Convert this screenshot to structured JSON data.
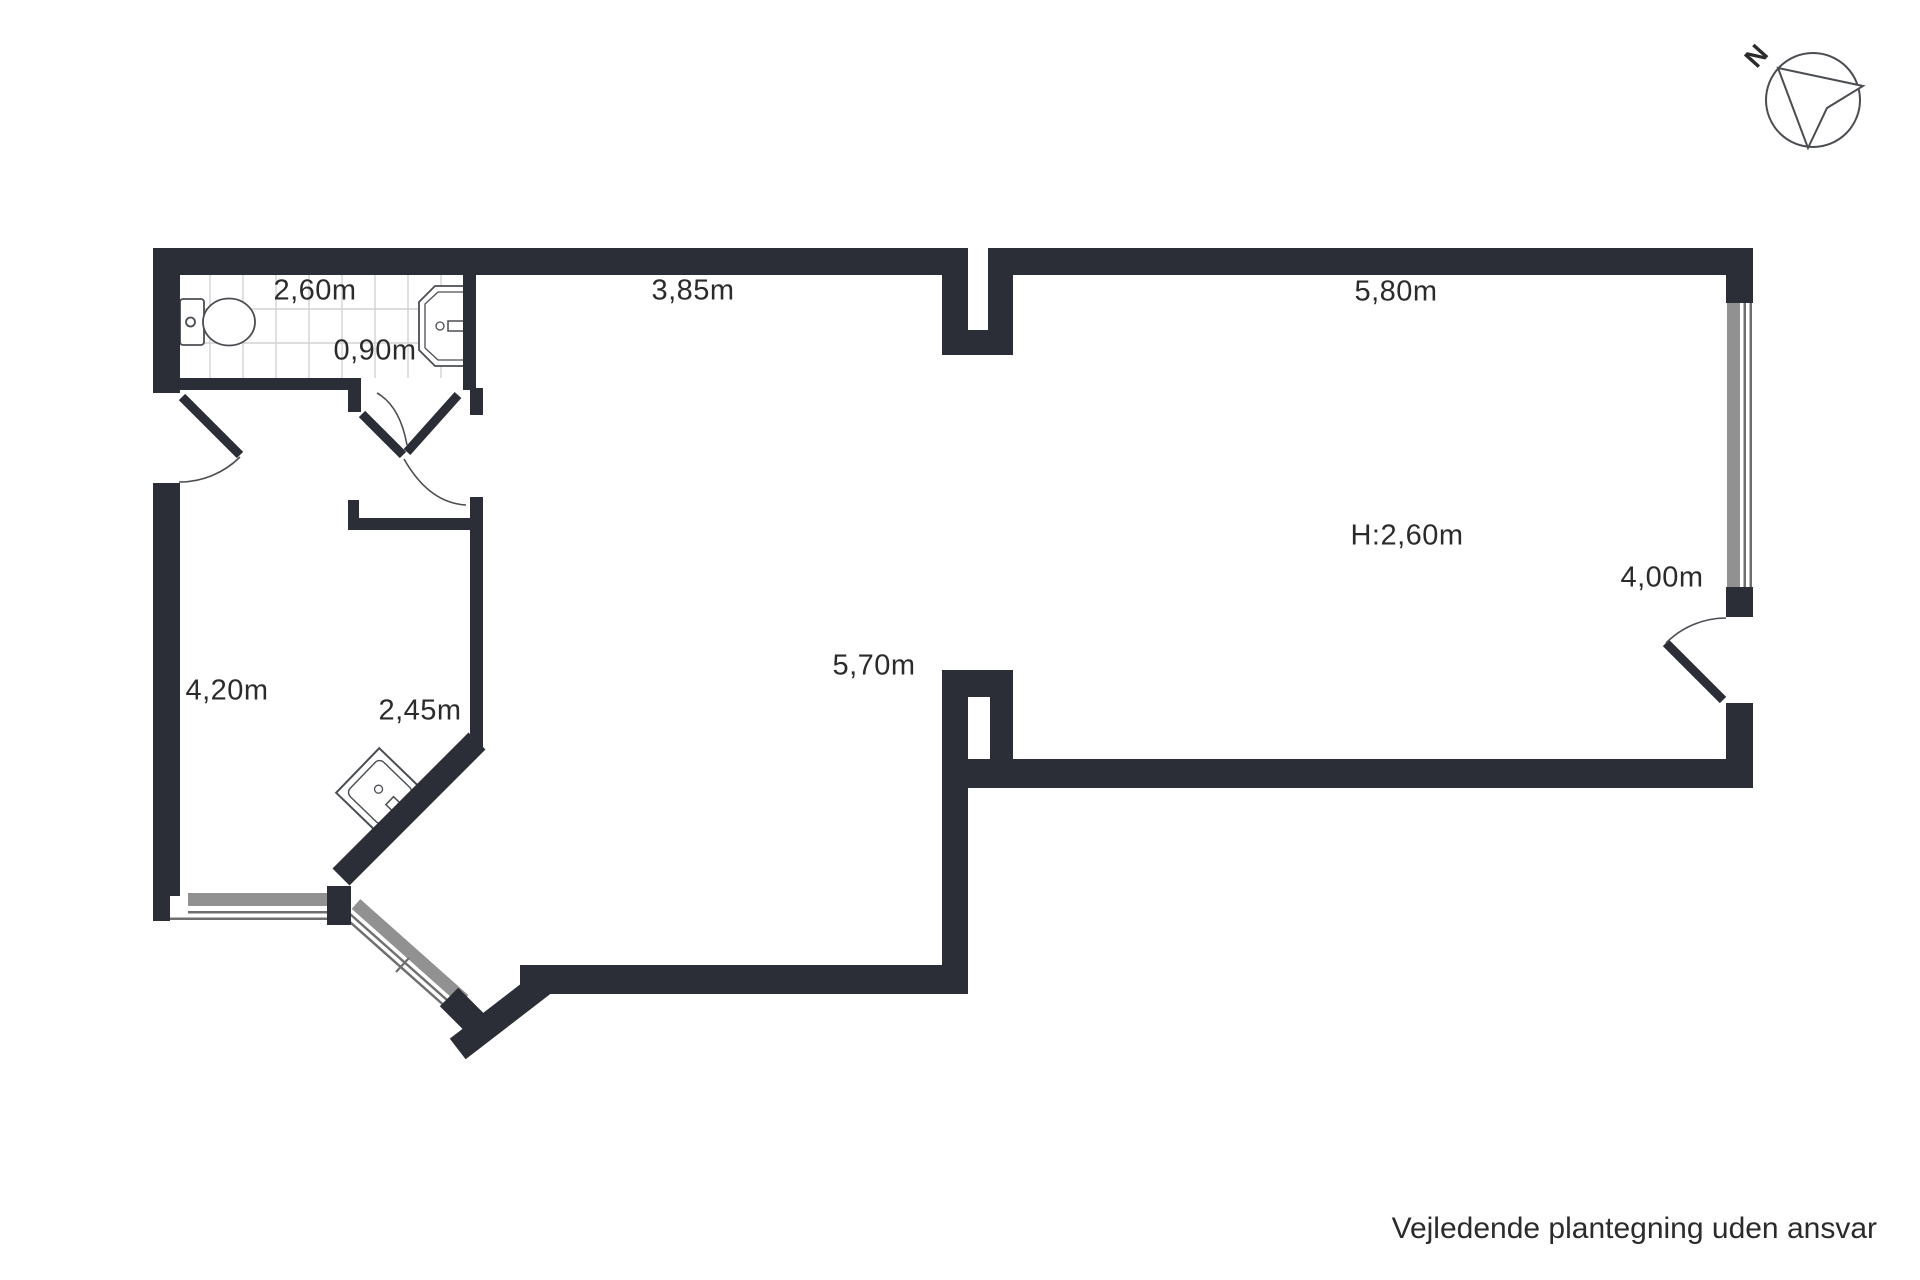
{
  "labels": [
    {
      "id": "bathroom-width",
      "text": "2,60m",
      "x": 315,
      "y": 291
    },
    {
      "id": "bathroom-depth",
      "text": "0,90m",
      "x": 375,
      "y": 351
    },
    {
      "id": "top-room-width",
      "text": "3,85m",
      "x": 693,
      "y": 291
    },
    {
      "id": "right-room-width",
      "text": "5,80m",
      "x": 1396,
      "y": 292
    },
    {
      "id": "ceiling-height",
      "text": "H:2,60m",
      "x": 1407,
      "y": 536
    },
    {
      "id": "right-room-depth",
      "text": "4,00m",
      "x": 1662,
      "y": 578
    },
    {
      "id": "left-room-depth",
      "text": "4,20m",
      "x": 227,
      "y": 691
    },
    {
      "id": "left-room-width",
      "text": "2,45m",
      "x": 420,
      "y": 711
    },
    {
      "id": "main-room-width",
      "text": "5,70m",
      "x": 874,
      "y": 666
    }
  ],
  "compass": {
    "label": "N"
  },
  "footer": {
    "disclaimer": "Vejledende plantegning uden ansvar"
  },
  "colors": {
    "wall": "#2b2e37",
    "line": "#4a4d52",
    "window_fill": "#919191",
    "window_frame": "#6f6f6f",
    "tile_line": "#d2d2d2",
    "text": "#2b2b2b",
    "background": "#ffffff"
  }
}
